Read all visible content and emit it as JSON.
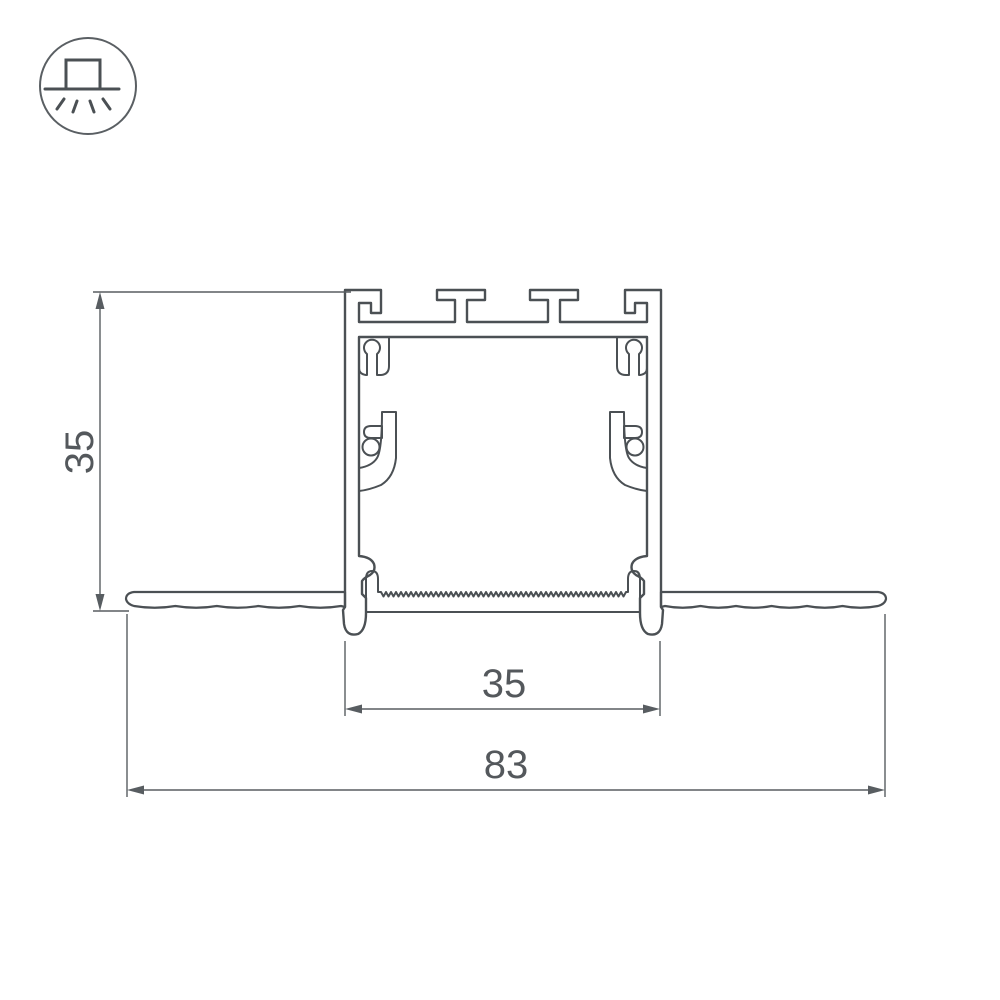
{
  "icon": {
    "name": "recessed-luminaire-icon"
  },
  "dimensions": {
    "height": "35",
    "inner_width": "35",
    "overall_width": "83"
  },
  "colors": {
    "outline": "#4b5054",
    "hatch_line": "#979da1",
    "profile_fill": "#ecedec",
    "dimension_line": "#585d61",
    "dimension_text": "#54585c",
    "background": "#ffffff"
  }
}
